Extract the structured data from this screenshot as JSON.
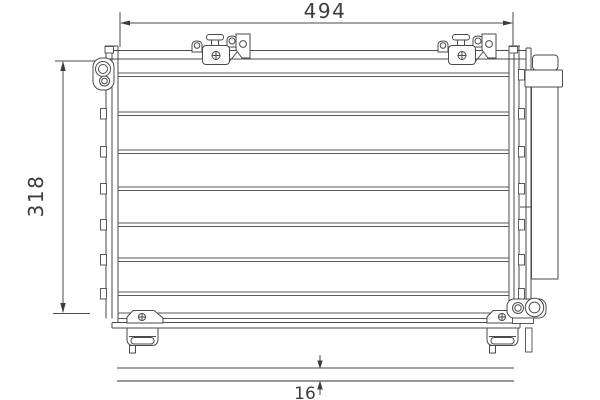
{
  "drawing": {
    "dimension_width": "494",
    "dimension_height": "318",
    "dimension_depth": "16"
  },
  "colors": {
    "line": "#4a4a4a",
    "separator": "#5a5a5a",
    "text": "#3d3d3d",
    "background": "#ffffff",
    "side_view_thick_line": "#999999"
  }
}
